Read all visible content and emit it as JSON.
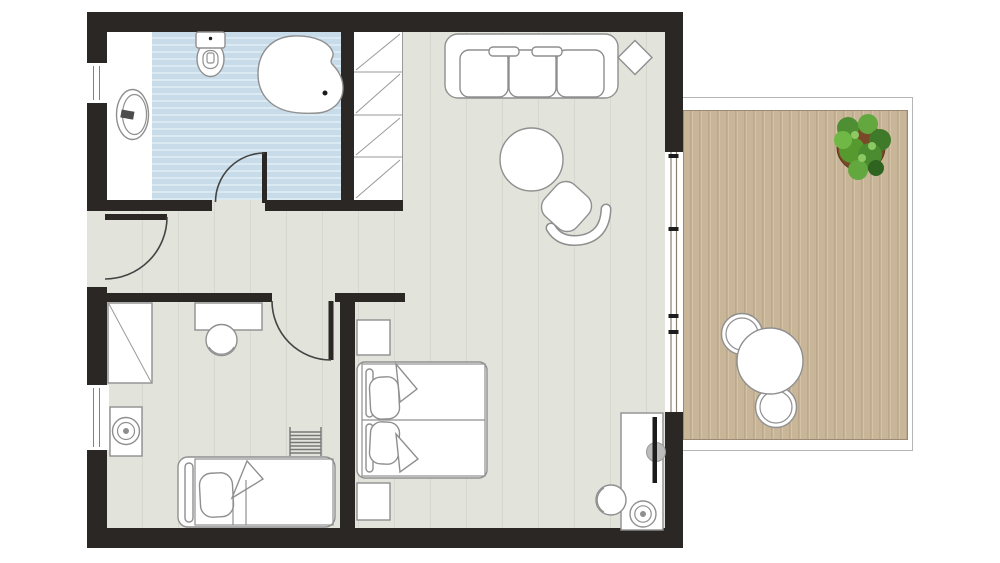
{
  "palette": {
    "wall": "#2b2724",
    "floor": "#e2e3db",
    "floor_line": "#d6d7cf",
    "bath_tile": "#c8dbe9",
    "bath_tile_light": "#dbe9f2",
    "deck": "#c9b699",
    "deck_dark": "#b09c81",
    "deck_light": "#d5c3a7",
    "outline": "#8f8f8f",
    "door": "#444444",
    "glass": "#8b7f6e",
    "plant_pot": "#7a4a28",
    "plant_green": "#4e8f33"
  },
  "plan": {
    "type": "floor-plan",
    "areas": {
      "bathroom": {
        "floor": "blue-tiles",
        "items": [
          "toilet",
          "corner-bathtub",
          "washbasin",
          "swing-door",
          "window"
        ]
      },
      "closet": {
        "items": [
          "shelf-cell",
          "shelf-cell",
          "shelf-cell",
          "shelf-cell"
        ]
      },
      "hallway": {
        "items": [
          "entry-door"
        ]
      },
      "living-room": {
        "floor": "tiles",
        "items": [
          "sofa-3-seat",
          "side-table-diamond",
          "round-coffee-table",
          "armchair",
          "media-console",
          "tv",
          "table-lamp",
          "chair"
        ]
      },
      "bedroom": {
        "items": [
          "double-bed",
          "nightstand",
          "nightstand"
        ]
      },
      "kids-room": {
        "items": [
          "wardrobe",
          "desk",
          "desk-chair",
          "single-bed",
          "ladder-radiator",
          "lamp-table",
          "window"
        ]
      },
      "terrace": {
        "floor": "wood-deck",
        "items": [
          "sliding-glass-door",
          "round-dining-table",
          "chair",
          "chair",
          "potted-plant"
        ]
      }
    }
  }
}
